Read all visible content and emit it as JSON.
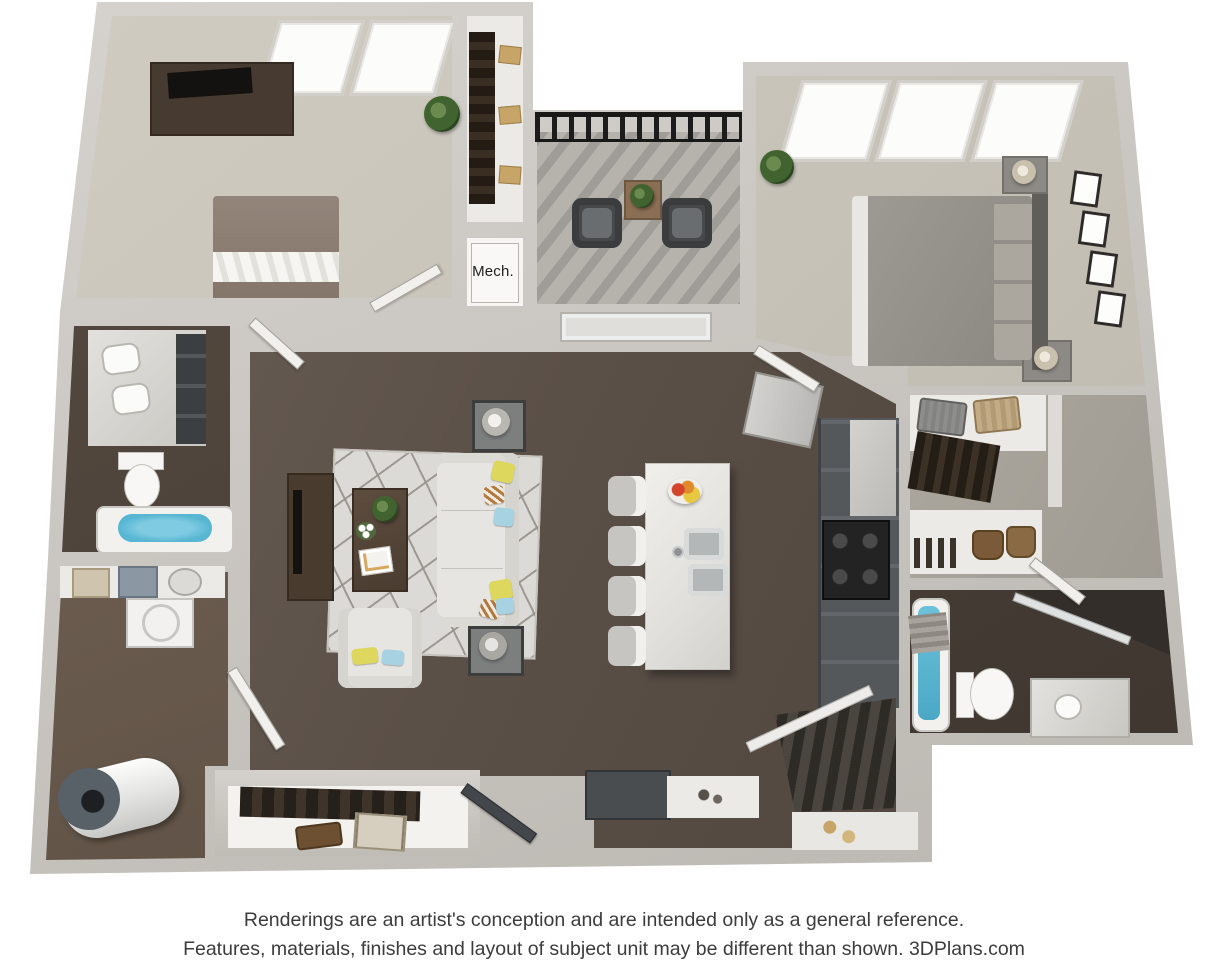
{
  "palette": {
    "wall": "#c9c5c0",
    "wallLight": "#dedbd7",
    "carpet": "#c8c4ba",
    "carpetDark": "#aca89f",
    "woodDark": "#5b5048",
    "woodDarker": "#463d36",
    "woodMed": "#6c5c4f",
    "concrete": "#b6b3ad",
    "white": "#f2f1ee",
    "marble": "#e9e7e4",
    "counterDark": "#55585a",
    "furnDark": "#473a30",
    "black": "#1b1b1b",
    "sofa": "#e7e5e1",
    "bedGray": "#96928c",
    "bedTaupe": "#8a7c6f",
    "accentYellow": "#ddd75e",
    "accentBlue": "#a7d2e2",
    "water": "#57b6d2",
    "green": "#41632f",
    "tan": "#c7a568",
    "steel": "#b7babb",
    "text": "#3c3c3c"
  },
  "floorplan": {
    "type": "3d-floor-plan-rendering",
    "mech_label": "Mech.",
    "rooms": [
      "bedroom-2",
      "reach-in-closet",
      "mechanical-closet",
      "balcony",
      "master-bedroom",
      "bathroom",
      "living-room",
      "kitchen",
      "walk-in-closet",
      "master-bathroom",
      "laundry-utility",
      "entry-closet",
      "entry-stairs"
    ],
    "furniture": {
      "bedroom_2": [
        "dresser-with-tv",
        "bed",
        "plant",
        "two-windows"
      ],
      "reach_in_closet": [
        "hanging-clothes",
        "storage-boxes"
      ],
      "balcony": [
        "metal-railing",
        "two-lounge-chairs",
        "side-table-with-plant"
      ],
      "master_bedroom": [
        "bed",
        "two-nightstands-with-lamps",
        "four-wall-frames",
        "plant",
        "three-windows"
      ],
      "bathroom": [
        "double-sink-vanity",
        "toilet",
        "bathtub"
      ],
      "living_room": [
        "tv-console",
        "area-rug",
        "coffee-table",
        "sofa-with-pillows",
        "armchair",
        "two-end-tables-with-lamps"
      ],
      "kitchen": [
        "island-with-sink",
        "four-bar-stools",
        "fruit-bowl",
        "refrigerator",
        "range",
        "cabinet-run"
      ],
      "walk_in_closet": [
        "hanging-clothes",
        "suitcases",
        "shelving",
        "handbags",
        "shoes"
      ],
      "master_bathroom": [
        "bathtub",
        "toilet",
        "vanity-sink",
        "glass-shower"
      ],
      "laundry_utility": [
        "water-heater",
        "washer",
        "storage-shelf-baskets"
      ],
      "entry": [
        "coat-closet",
        "briefcase",
        "suitcase",
        "bench",
        "console",
        "stairs-with-railing",
        "front-door"
      ]
    }
  },
  "disclaimer": {
    "line1": "Renderings are an artist's conception and are intended only as a general reference.",
    "line2": "Features, materials, finishes and layout of subject unit may be different than shown. 3DPlans.com"
  }
}
